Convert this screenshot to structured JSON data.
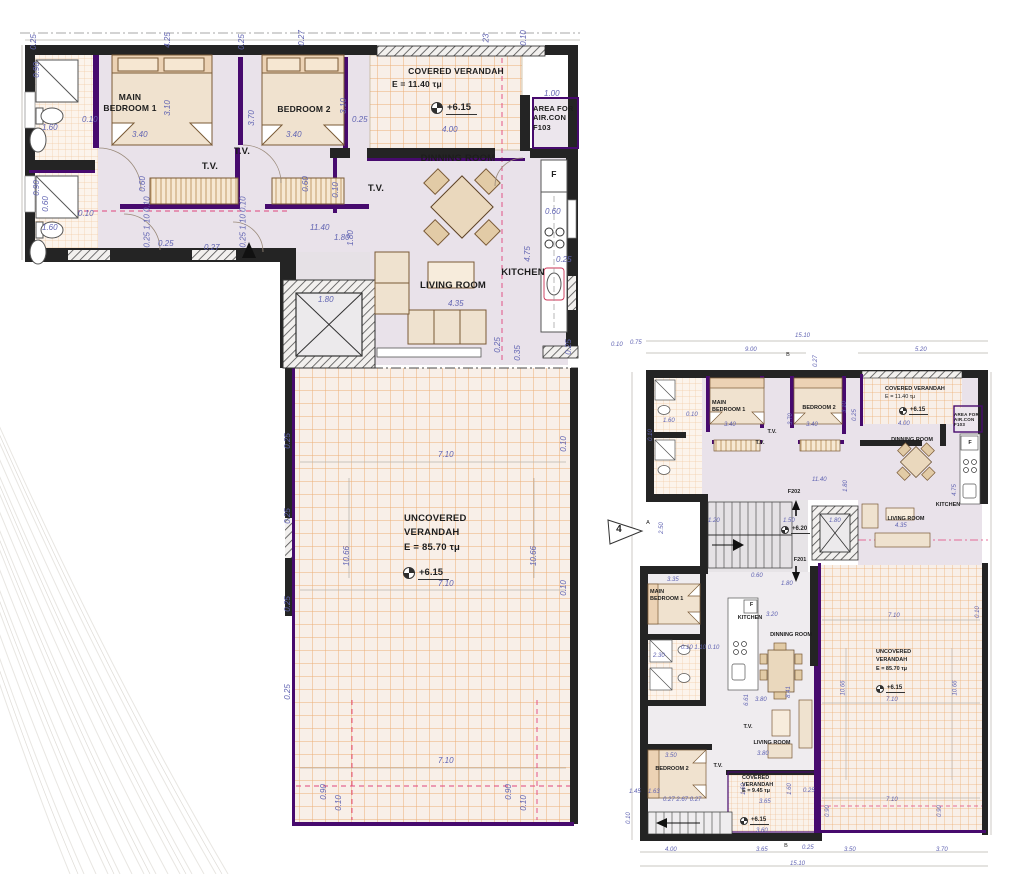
{
  "colors": {
    "wall": "#242424",
    "accent_purple": "#470a6e",
    "floor": "#e9e2ea",
    "floor_lower": "#efecef",
    "verandah_bg": "#f8efe8",
    "verandah_grid": "#ecaf76",
    "tile_bg": "#fcf4ec",
    "tile_grid": "#f2cda6",
    "dim_text": "#6063b2",
    "dim_marker": "#d63d74",
    "furniture": "#f0e2cf",
    "furniture_stroke": "#7a5a36"
  },
  "left_plan": {
    "labels": {
      "main_bedroom": "MAIN\nBEDROOM 1",
      "bedroom2": "BEDROOM 2",
      "tv_a": "T.V.",
      "tv_b": "T.V.",
      "tv_c": "T.V.",
      "covered_verandah": "COVERED VERANDAH",
      "covered_verandah_area": "E = 11.40 τμ",
      "covered_level": "+6.15",
      "aircon": "AREA FOR\nAIR.CON\nF103",
      "dinning": "DINNING ROOM",
      "kitchen": "KITCHEN",
      "fridge": "F",
      "living": "LIVING ROOM",
      "uncovered": "UNCOVERED\nVERANDAH\nE = 85.70 τμ",
      "uncovered_level": "+6.15"
    },
    "dims": [
      {
        "t": "0.25",
        "x": 26,
        "y": 38,
        "r": -90
      },
      {
        "t": "4.25",
        "x": 160,
        "y": 36,
        "r": -90
      },
      {
        "t": "0.25",
        "x": 234,
        "y": 38,
        "r": -90
      },
      {
        "t": "0.27",
        "x": 294,
        "y": 34,
        "r": -90
      },
      {
        "t": "23",
        "x": 482,
        "y": 34,
        "r": -90
      },
      {
        "t": "0.10",
        "x": 516,
        "y": 34,
        "r": -90
      },
      {
        "t": "1.00",
        "x": 544,
        "y": 90
      },
      {
        "t": "0.90",
        "x": 29,
        "y": 66,
        "r": -90
      },
      {
        "t": "1.60",
        "x": 42,
        "y": 124
      },
      {
        "t": "0.10",
        "x": 82,
        "y": 116
      },
      {
        "t": "3.10",
        "x": 160,
        "y": 104,
        "r": -90
      },
      {
        "t": "3.40",
        "x": 132,
        "y": 131
      },
      {
        "t": "3.70",
        "x": 244,
        "y": 114,
        "r": -90
      },
      {
        "t": "3.40",
        "x": 286,
        "y": 131
      },
      {
        "t": "3.10",
        "x": 336,
        "y": 102,
        "r": -90
      },
      {
        "t": "0.25",
        "x": 352,
        "y": 116
      },
      {
        "t": "4.00",
        "x": 442,
        "y": 126
      },
      {
        "t": "0.90",
        "x": 29,
        "y": 184,
        "r": -90
      },
      {
        "t": "0.60",
        "x": 38,
        "y": 200,
        "r": -90
      },
      {
        "t": "1.60",
        "x": 42,
        "y": 224
      },
      {
        "t": "0.10",
        "x": 78,
        "y": 210
      },
      {
        "t": "0.60",
        "x": 135,
        "y": 180,
        "r": -90
      },
      {
        "t": "0.60",
        "x": 298,
        "y": 180,
        "r": -90
      },
      {
        "t": "0.10",
        "x": 328,
        "y": 186,
        "r": -90
      },
      {
        "t": "0.25 1.10 0.10",
        "x": 122,
        "y": 218,
        "r": -90
      },
      {
        "t": "0.25 1.10 0.10",
        "x": 218,
        "y": 218,
        "r": -90
      },
      {
        "t": "11.40",
        "x": 310,
        "y": 224
      },
      {
        "t": "1.80",
        "x": 343,
        "y": 234,
        "r": -90
      },
      {
        "t": "1.80",
        "x": 334,
        "y": 234
      },
      {
        "t": "0.25",
        "x": 158,
        "y": 240
      },
      {
        "t": "0.27",
        "x": 204,
        "y": 244
      },
      {
        "t": "1.80",
        "x": 318,
        "y": 296
      },
      {
        "t": "4.35",
        "x": 448,
        "y": 300
      },
      {
        "t": "0.60",
        "x": 545,
        "y": 208
      },
      {
        "t": "0.25",
        "x": 556,
        "y": 256
      },
      {
        "t": "4.75",
        "x": 520,
        "y": 250,
        "r": -90
      },
      {
        "t": "0.35",
        "x": 510,
        "y": 349,
        "r": -90
      },
      {
        "t": "0.25",
        "x": 490,
        "y": 341,
        "r": -90
      },
      {
        "t": "0.25",
        "x": 561,
        "y": 343,
        "r": -90
      },
      {
        "t": "0.10",
        "x": 556,
        "y": 440,
        "r": -90
      },
      {
        "t": "0.10",
        "x": 556,
        "y": 584,
        "r": -90
      },
      {
        "t": "7.10",
        "x": 438,
        "y": 451
      },
      {
        "t": "7.10",
        "x": 438,
        "y": 580
      },
      {
        "t": "7.10",
        "x": 438,
        "y": 757
      },
      {
        "t": "10.66",
        "x": 337,
        "y": 552,
        "r": -90
      },
      {
        "t": "10.66",
        "x": 524,
        "y": 552,
        "r": -90
      },
      {
        "t": "0.25",
        "x": 280,
        "y": 437,
        "r": -90
      },
      {
        "t": "0.25",
        "x": 280,
        "y": 512,
        "r": -90
      },
      {
        "t": "0.25",
        "x": 280,
        "y": 600,
        "r": -90
      },
      {
        "t": "0.25",
        "x": 280,
        "y": 688,
        "r": -90
      },
      {
        "t": "0.90",
        "x": 316,
        "y": 788,
        "r": -90
      },
      {
        "t": "0.10",
        "x": 331,
        "y": 799,
        "r": -90
      },
      {
        "t": "0.90",
        "x": 501,
        "y": 788,
        "r": -90
      },
      {
        "t": "0.10",
        "x": 516,
        "y": 799,
        "r": -90
      }
    ]
  },
  "right_plan": {
    "labels": {
      "main_bedroom_u": "MAIN\nBEDROOM 1",
      "bedroom2_u": "BEDROOM 2",
      "covered_verandah_u": "COVERED VERANDAH",
      "covered_verandah_u_area": "E = 11.40 τμ",
      "covered_u_level": "+6.15",
      "aircon": "AREA FOR\nAIR.CON\nF103",
      "dinning_u": "DINNING ROOM",
      "kitchen_u": "KITCHEN",
      "living_u": "LIVING ROOM",
      "tv_u1": "T.V.",
      "tv_u2": "T.V.",
      "stair_f202": "F202",
      "stair_f201": "F201",
      "stair_level": "+6.20",
      "section_num": "4",
      "section_a": "A",
      "section_b": "B",
      "section_b2": "B",
      "main_bedroom_l": "MAIN\nBEDROOM 1",
      "bedroom2_l": "BEDROOM 2",
      "kitchen_l": "KITCHEN",
      "dinning_l": "DINNING ROOM",
      "living_l": "LIVING ROOM",
      "tv_l1": "T.V.",
      "tv_l2": "T.V.",
      "covered_l": "COVERED\nVERANDAH\nE = 9.45 τμ",
      "covered_l_level": "+6.15",
      "uncovered": "UNCOVERED\nVERANDAH\nE = 85.70 τμ",
      "uncovered_level": "+6.15",
      "fridge_u": "F",
      "fridge_l": "F"
    },
    "dims": [
      {
        "t": "15.10",
        "x": 795,
        "y": 333
      },
      {
        "t": "9.00",
        "x": 745,
        "y": 347
      },
      {
        "t": "5.20",
        "x": 915,
        "y": 347
      },
      {
        "t": "0.75",
        "x": 630,
        "y": 340
      },
      {
        "t": "0.10",
        "x": 611,
        "y": 342
      },
      {
        "t": "0.27",
        "x": 810,
        "y": 358,
        "r": -90
      },
      {
        "t": "1.60",
        "x": 663,
        "y": 418
      },
      {
        "t": "0.10",
        "x": 686,
        "y": 412
      },
      {
        "t": "3.40",
        "x": 724,
        "y": 422
      },
      {
        "t": "3.40",
        "x": 806,
        "y": 422
      },
      {
        "t": "3.70",
        "x": 785,
        "y": 416,
        "r": -90
      },
      {
        "t": "3.10",
        "x": 839,
        "y": 404,
        "r": -90
      },
      {
        "t": "0.25",
        "x": 849,
        "y": 412,
        "r": -90
      },
      {
        "t": "4.00",
        "x": 898,
        "y": 421
      },
      {
        "t": "0.10",
        "x": 645,
        "y": 432,
        "r": -90
      },
      {
        "t": "11.40",
        "x": 812,
        "y": 477
      },
      {
        "t": "1.80",
        "x": 840,
        "y": 483,
        "r": -90
      },
      {
        "t": "4.75",
        "x": 949,
        "y": 487,
        "r": -90
      },
      {
        "t": "4.35",
        "x": 895,
        "y": 523
      },
      {
        "t": "1.20",
        "x": 708,
        "y": 518
      },
      {
        "t": "1.50",
        "x": 783,
        "y": 518
      },
      {
        "t": "1.80",
        "x": 829,
        "y": 518
      },
      {
        "t": "2.50",
        "x": 656,
        "y": 525,
        "r": -90
      },
      {
        "t": "0.60",
        "x": 751,
        "y": 573
      },
      {
        "t": "1.80",
        "x": 781,
        "y": 581
      },
      {
        "t": "3.20",
        "x": 766,
        "y": 612
      },
      {
        "t": "3.35",
        "x": 667,
        "y": 577
      },
      {
        "t": "0.10 1.10 0.10",
        "x": 681,
        "y": 645
      },
      {
        "t": "2.30",
        "x": 653,
        "y": 653
      },
      {
        "t": "8.41",
        "x": 783,
        "y": 689,
        "r": -90
      },
      {
        "t": "6.61",
        "x": 741,
        "y": 697,
        "r": -90
      },
      {
        "t": "3.80",
        "x": 755,
        "y": 697
      },
      {
        "t": "3.80",
        "x": 757,
        "y": 751
      },
      {
        "t": "3.50",
        "x": 665,
        "y": 753
      },
      {
        "t": "0.27 2.67 0.27",
        "x": 663,
        "y": 797
      },
      {
        "t": "1.45",
        "x": 629,
        "y": 789
      },
      {
        "t": "1.63",
        "x": 648,
        "y": 789
      },
      {
        "t": "3.65",
        "x": 759,
        "y": 799
      },
      {
        "t": "1.60",
        "x": 738,
        "y": 786,
        "r": -90
      },
      {
        "t": "1.60",
        "x": 784,
        "y": 786,
        "r": -90
      },
      {
        "t": "0.25",
        "x": 803,
        "y": 788
      },
      {
        "t": "3.60",
        "x": 756,
        "y": 828
      },
      {
        "t": "7.10",
        "x": 888,
        "y": 613
      },
      {
        "t": "7.10",
        "x": 886,
        "y": 697
      },
      {
        "t": "7.10",
        "x": 886,
        "y": 797
      },
      {
        "t": "10.66",
        "x": 836,
        "y": 685,
        "r": -90
      },
      {
        "t": "10.66",
        "x": 948,
        "y": 685,
        "r": -90
      },
      {
        "t": "0.90",
        "x": 822,
        "y": 808,
        "r": -90
      },
      {
        "t": "0.90",
        "x": 934,
        "y": 808,
        "r": -90
      },
      {
        "t": "0.10",
        "x": 972,
        "y": 609,
        "r": -90
      },
      {
        "t": "0.10",
        "x": 623,
        "y": 815,
        "r": -90
      },
      {
        "t": "4.00",
        "x": 665,
        "y": 847
      },
      {
        "t": "3.65",
        "x": 756,
        "y": 847
      },
      {
        "t": "0.25",
        "x": 802,
        "y": 845
      },
      {
        "t": "3.50",
        "x": 844,
        "y": 847
      },
      {
        "t": "3.70",
        "x": 936,
        "y": 847
      },
      {
        "t": "15.10",
        "x": 790,
        "y": 861
      }
    ]
  }
}
